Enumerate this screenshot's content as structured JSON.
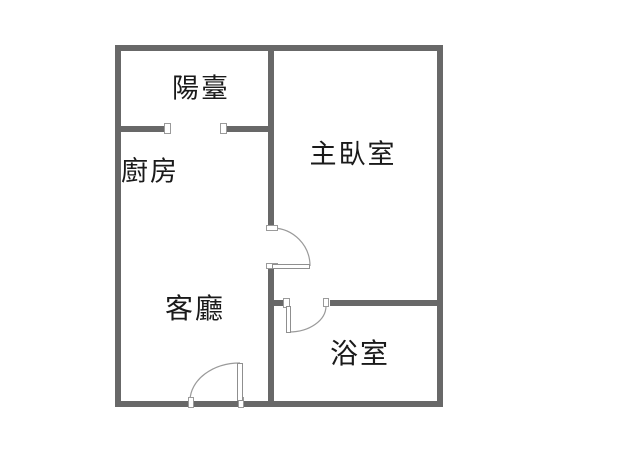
{
  "floorplan": {
    "title": "apartment-floor-plan",
    "rooms": [
      {
        "id": "balcony",
        "label": "陽臺"
      },
      {
        "id": "kitchen",
        "label": "廚房"
      },
      {
        "id": "master-bedroom",
        "label": "主臥室"
      },
      {
        "id": "living-room",
        "label": "客廳"
      },
      {
        "id": "bathroom",
        "label": "浴室"
      }
    ],
    "doors": [
      {
        "id": "balcony-sliding-opening",
        "between": [
          "balcony",
          "kitchen"
        ]
      },
      {
        "id": "bedroom-door",
        "between": [
          "living-room",
          "master-bedroom"
        ]
      },
      {
        "id": "bathroom-door",
        "between": [
          "living-room",
          "bathroom"
        ]
      },
      {
        "id": "entrance-door",
        "between": [
          "outside",
          "living-room"
        ]
      }
    ],
    "colors": {
      "wall": "#686868",
      "door_line": "#9a9a9a",
      "text": "#1a1a1a",
      "background": "#ffffff"
    }
  }
}
